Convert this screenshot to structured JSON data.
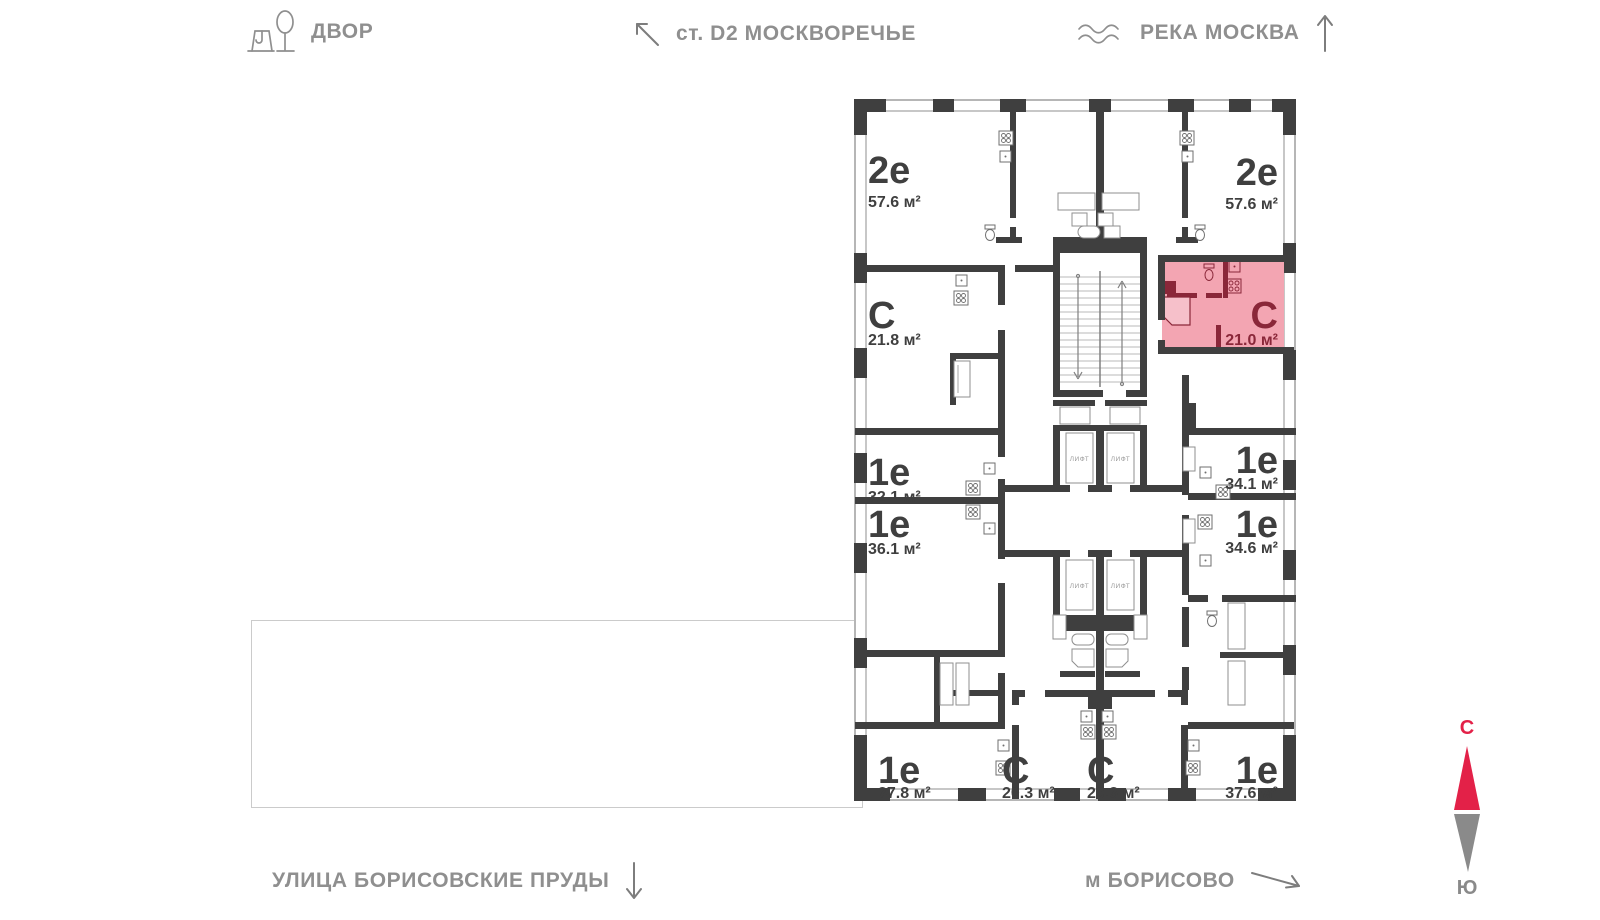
{
  "overlay_labels": {
    "courtyard": "ДВОР",
    "station": "ст. D2 МОСКВОРЕЧЬЕ",
    "river": "РЕКА МОСКВА",
    "street": "УЛИЦА БОРИСОВСКИЕ ПРУДЫ",
    "metro": "м БОРИСОВО"
  },
  "compass": {
    "north": "С",
    "south": "Ю"
  },
  "floor_plan": {
    "elevator_label": "ЛИФТ",
    "apartments": [
      {
        "id": "2e-top-left",
        "type": "2е",
        "area": "57.6 м²",
        "highlighted": false
      },
      {
        "id": "2e-top-right",
        "type": "2е",
        "area": "57.6 м²",
        "highlighted": false
      },
      {
        "id": "s-21-8",
        "type": "С",
        "area": "21.8 м²",
        "highlighted": false
      },
      {
        "id": "s-21-0-selected",
        "type": "С",
        "area": "21.0 м²",
        "highlighted": true
      },
      {
        "id": "1e-32-1",
        "type": "1е",
        "area": "32.1 м²",
        "highlighted": false
      },
      {
        "id": "1e-36-1",
        "type": "1е",
        "area": "36.1 м²",
        "highlighted": false
      },
      {
        "id": "1e-34-1",
        "type": "1е",
        "area": "34.1 м²",
        "highlighted": false
      },
      {
        "id": "1e-34-6",
        "type": "1е",
        "area": "34.6 м²",
        "highlighted": false
      },
      {
        "id": "1e-37-8",
        "type": "1е",
        "area": "37.8 м²",
        "highlighted": false
      },
      {
        "id": "s-20-3-left",
        "type": "С",
        "area": "20.3 м²",
        "highlighted": false
      },
      {
        "id": "s-20-3-right",
        "type": "С",
        "area": "20.3 м²",
        "highlighted": false
      },
      {
        "id": "1e-37-6",
        "type": "1е",
        "area": "37.6 м²",
        "highlighted": false
      }
    ]
  },
  "colors": {
    "wall": "#3f3f3f",
    "highlight_fill": "#f3a5b2",
    "highlight_accent": "#8a2739",
    "map_label_gray": "#8f8f8f",
    "compass_north_red": "#e32148",
    "compass_south_gray": "#8a8a8a"
  }
}
